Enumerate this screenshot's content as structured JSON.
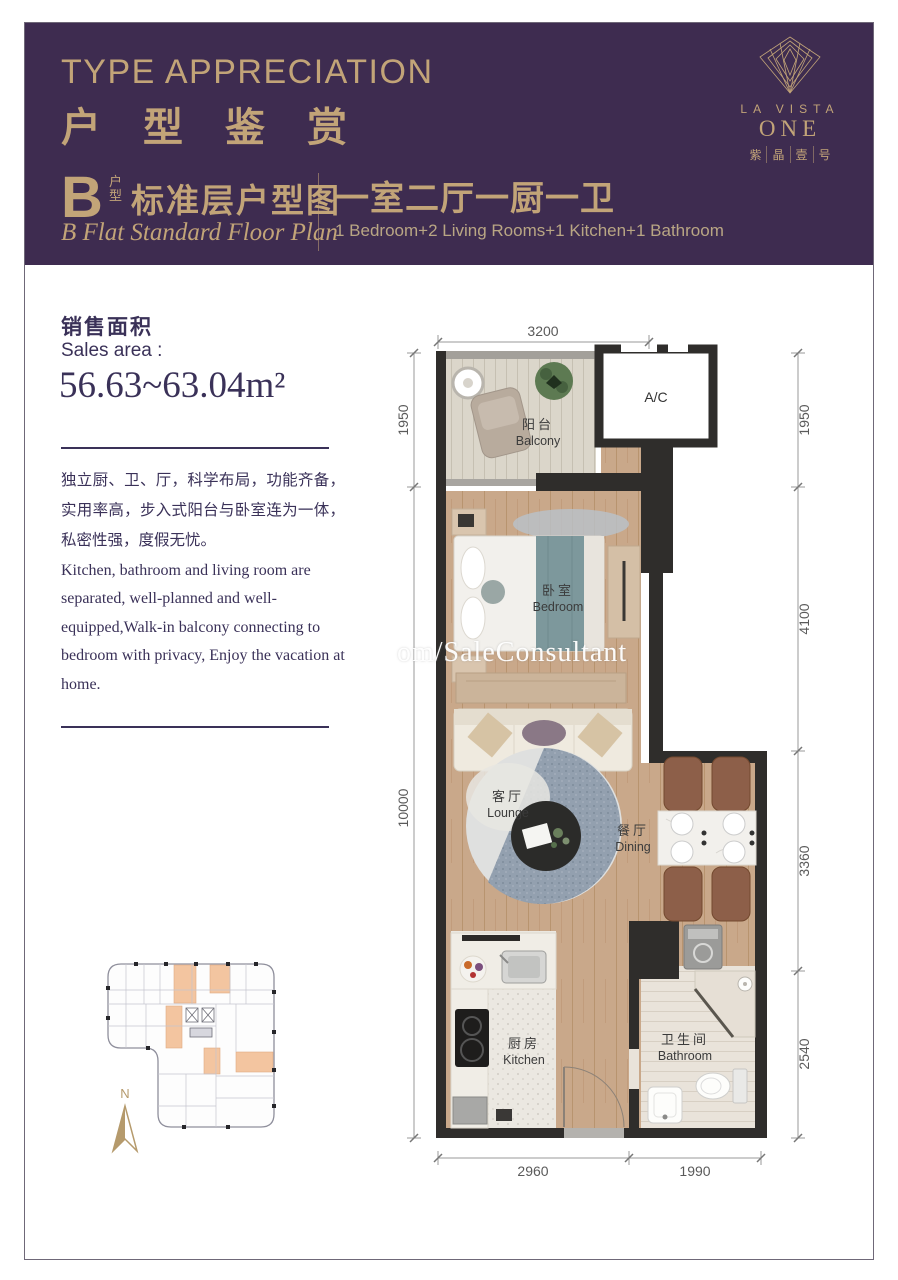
{
  "colors": {
    "header_purple": "#3E2C50",
    "gold": "#C2A478",
    "body_text_purple": "#3A3158",
    "wall_dark": "#2F2D2B",
    "wood_floor": "#C9A88A",
    "keyplan_highlight": "#F3C5A0"
  },
  "header": {
    "title_en": "TYPE APPRECIATION",
    "title_zh": "户型鉴赏",
    "plan_code": "B",
    "plan_code_sub_top": "户",
    "plan_code_sub_bottom": "型",
    "subtitle_zh": "标准层户型图",
    "subtitle_en": "B Flat Standard Floor Plan",
    "layout_zh": "一室二厅一厨一卫",
    "layout_en": "1 Bedroom+2 Living Rooms+1 Kitchen+1 Bathroom",
    "logo": {
      "name_top": "LA VISTA",
      "name_main": "ONE",
      "cn_chars": [
        "紫",
        "晶",
        "壹",
        "号"
      ]
    }
  },
  "sales": {
    "label_zh": "销售面积",
    "label_en": "Sales area :",
    "value": "56.63~63.04m²"
  },
  "description": {
    "zh": "独立厨、卫、厅，科学布局，功能齐备，实用率高，步入式阳台与卧室连为一体，私密性强，度假无忧。",
    "en": "Kitchen, bathroom and living room are separated, well-planned and well-equipped,Walk-in balcony connecting to bedroom with privacy, Enjoy the vacation at home."
  },
  "floorplan": {
    "ac_label": "A/C",
    "watermark": "om/SaleConsultant",
    "rooms": {
      "balcony": {
        "zh": "阳台",
        "en": "Balcony"
      },
      "bedroom": {
        "zh": "卧室",
        "en": "Bedroom"
      },
      "lounge": {
        "zh": "客厅",
        "en": "Lounge"
      },
      "dining": {
        "zh": "餐厅",
        "en": "Dining"
      },
      "kitchen": {
        "zh": "厨房",
        "en": "Kitchen"
      },
      "bathroom": {
        "zh": "卫生间",
        "en": "Bathroom"
      }
    },
    "dimensions": {
      "top": "3200",
      "left": [
        "1950",
        "10000"
      ],
      "right": [
        "1950",
        "4100",
        "3360",
        "2540"
      ],
      "bottom": [
        "2960",
        "1990"
      ]
    }
  },
  "keyplan": {
    "north_label": "N"
  }
}
